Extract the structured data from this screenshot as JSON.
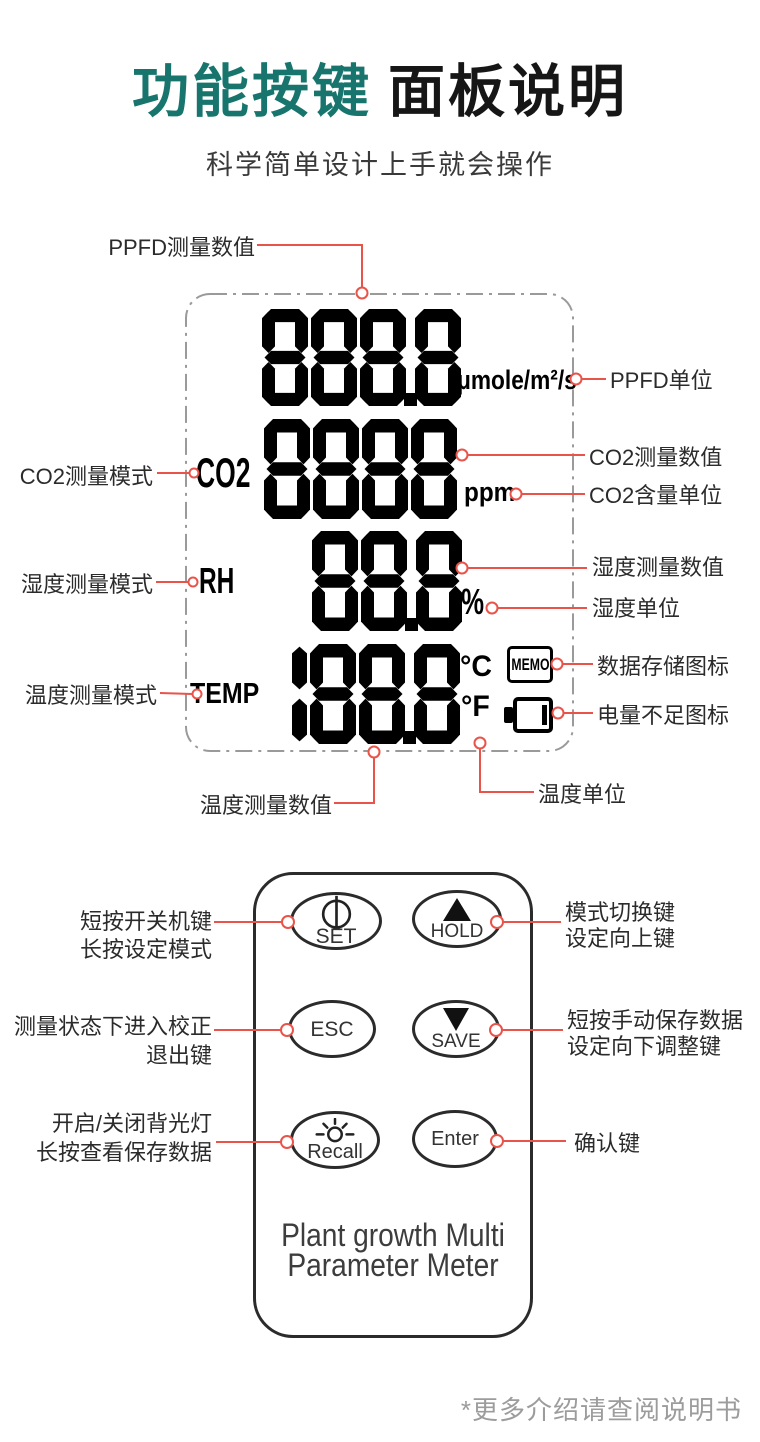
{
  "page": {
    "title_accent": "功能按键",
    "title_rest": "面板说明",
    "subtitle": "科学简单设计上手就会操作",
    "footer_note": "*更多介绍请查阅说明书"
  },
  "colors": {
    "accent_teal": "#17756d",
    "callout_red": "#e8544a",
    "lcd_black": "#000000",
    "keypad_border": "#2b2b2b"
  },
  "lcd": {
    "ppfd": {
      "value": "888.8",
      "unit": "μmole/m²/s"
    },
    "co2": {
      "mode": "CO2",
      "value": "8888",
      "unit": "ppm"
    },
    "humidity": {
      "mode": "RH",
      "value": "88.8",
      "unit": "%"
    },
    "temperature": {
      "mode": "TEMP",
      "value": "188.8",
      "unit_celsius": "°C",
      "unit_fahrenheit": "°F"
    },
    "memo_icon_text": "MEMO",
    "callouts": {
      "ppfd_value": "PPFD测量数值",
      "ppfd_unit": "PPFD单位",
      "co2_mode": "CO2测量模式",
      "co2_value": "CO2测量数值",
      "co2_unit": "CO2含量单位",
      "humidity_mode": "湿度测量模式",
      "humidity_value": "湿度测量数值",
      "humidity_unit": "湿度单位",
      "temp_mode": "温度测量模式",
      "memo": "数据存储图标",
      "battery": "电量不足图标",
      "temp_value": "温度测量数值",
      "temp_unit": "温度单位"
    }
  },
  "keypad": {
    "buttons": {
      "set": "SET",
      "hold": "HOLD",
      "esc": "ESC",
      "save": "SAVE",
      "recall": "Recall",
      "enter": "Enter"
    },
    "device_name_line1": "Plant growth Multi",
    "device_name_line2": "Parameter Meter",
    "callouts": {
      "set_line1": "短按开关机键",
      "set_line2": "长按设定模式",
      "hold_line1": "模式切换键",
      "hold_line2": "设定向上键",
      "esc_line1": "测量状态下进入校正",
      "esc_line2": "退出键",
      "save_line1": "短按手动保存数据",
      "save_line2": "设定向下调整键",
      "recall_line1": "开启/关闭背光灯",
      "recall_line2": "长按查看保存数据",
      "enter_line1": "确认键"
    }
  }
}
